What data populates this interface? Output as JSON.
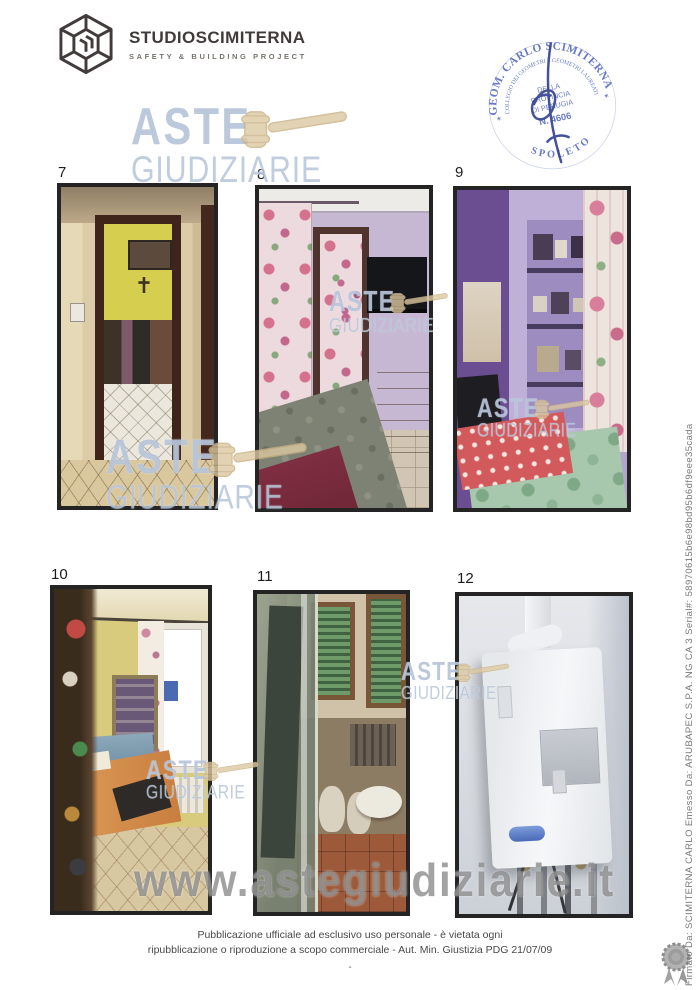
{
  "header": {
    "brand": "STUDIOSCIMITERNA",
    "tagline": "SAFETY & BUILDING PROJECT"
  },
  "stamp": {
    "outer_arc": "GEOM. CARLO SCIMITERNA",
    "inner_arc": "COLLEGIO DEI GEOMETRI E GEOMETRI LAUREATI",
    "bottom_arc": "SPOLETO",
    "center_line1": "DELLA",
    "center_line2": "PROVINCIA",
    "center_line3": "DI PERUGIA",
    "center_line4": "N. 4606",
    "star": "✶"
  },
  "watermark": {
    "word1": "ASTE",
    "word2": "GIUDIZIARIE",
    "url": "www.astegiudiziarie.it"
  },
  "photos": [
    {
      "number": "7"
    },
    {
      "number": "8"
    },
    {
      "number": "9"
    },
    {
      "number": "10"
    },
    {
      "number": "11"
    },
    {
      "number": "12"
    }
  ],
  "side_signature": "Firmato Da: SCIMITERNA CARLO Emesso Da: ARUBAPEC S.P.A. NG CA 3 Serial#: 58970615b6e98bd95b6df9eee35cada",
  "footer": {
    "line1": "Pubblicazione ufficiale ad esclusivo uso personale - è vietata ogni",
    "line2": "ripubblicazione o riproduzione a scopo commerciale - Aut. Min. Giustizia PDG 21/07/09",
    "dash": "-"
  },
  "colors": {
    "stamp_blue": "#4156b8",
    "watermark_blue": "#b0c0d6",
    "gavel_tan": "#dcc9a2",
    "url_gray": "#808080"
  }
}
